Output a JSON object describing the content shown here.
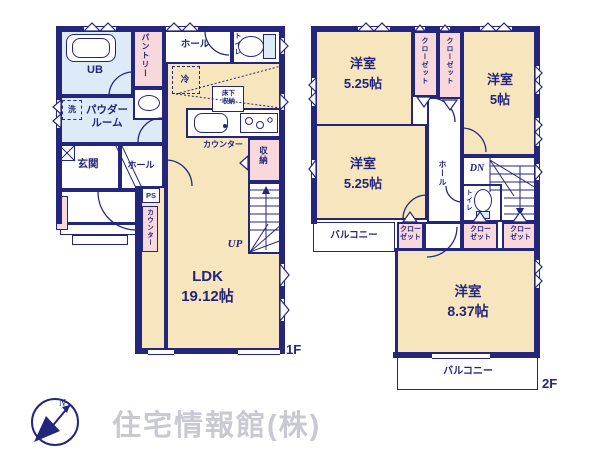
{
  "colors": {
    "wall": "#23267b",
    "room_cream": "#f6e5bd",
    "closet_pink": "#f9d8db",
    "bath_blue": "#dcebf7",
    "watermark_gray": "#c9c9d2"
  },
  "floor1": {
    "tag": "1F",
    "rooms": {
      "ub": "UB",
      "pantry": "パントリー",
      "hall_top": "ホール",
      "toilet": "トイレ",
      "fridge": "冷",
      "underfloor": "床下収納",
      "wash": "洗",
      "powder": "パウダールーム",
      "counter_kitchen": "カウンター",
      "genkan": "玄関",
      "hall": "ホール",
      "ps": "PS",
      "counter_side": "カウンター",
      "storage": "収納",
      "up": "UP",
      "ldk_name": "LDK",
      "ldk_size": "19.12帖"
    }
  },
  "floor2": {
    "tag": "2F",
    "rooms": {
      "room1": "洋室",
      "room1_size": "5.25帖",
      "closet1": "クローゼット",
      "closet2": "クローゼット",
      "room2": "洋室",
      "room2_size": "5帖",
      "room3": "洋室",
      "room3_size": "5.25帖",
      "hall": "ホール",
      "dn": "DN",
      "toilet": "トイレ",
      "balcony_left": "バルコニー",
      "closet3": "クローゼット",
      "closet4": "クローゼット",
      "closet5": "クローゼット",
      "room4": "洋室",
      "room4_size": "8.37帖",
      "balcony_bottom": "バルコニー"
    }
  },
  "footer": {
    "company": "住宅情報館(株)",
    "north": "N"
  }
}
